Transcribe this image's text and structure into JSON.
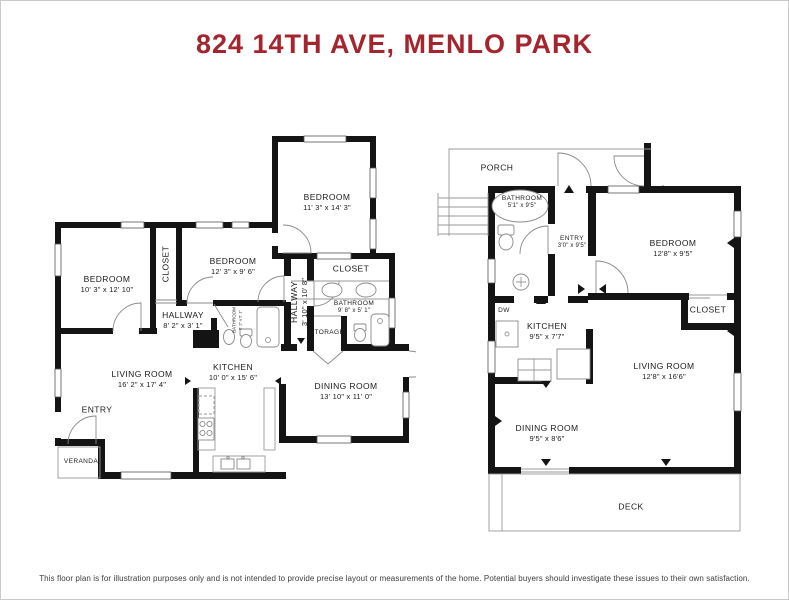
{
  "title": "824 14TH AVE, MENLO PARK",
  "colors": {
    "title": "#A4252E",
    "wall": "#141414"
  },
  "disclaimer": "This floor plan is for illustration purposes only and is not intended to provide precise layout or measurements of the home. Potential buyers should investigate these issues to their own satisfaction.",
  "plans": {
    "left": {
      "rooms": [
        {
          "name": "BEDROOM",
          "dims": "10' 3\" x 12' 10\""
        },
        {
          "name": "CLOSET"
        },
        {
          "name": "BEDROOM",
          "dims": "12' 3\" x 9' 6\""
        },
        {
          "name": "BEDROOM",
          "dims": "11' 3\" x 14' 3\""
        },
        {
          "name": "HALLWAY",
          "dims": "8' 2\" x 3' 1\""
        },
        {
          "name": "BATHROOM",
          "dims": "5' 2\" x 5' 1\""
        },
        {
          "name": "HALLWAY",
          "dims": "3' 10\" x 10' 8\""
        },
        {
          "name": "CLOSET"
        },
        {
          "name": "BATHROOM",
          "dims": "9' 8\" x 5' 1\""
        },
        {
          "name": "STORAGE"
        },
        {
          "name": "LIVING ROOM",
          "dims": "16' 2\" x 17' 4\""
        },
        {
          "name": "KITCHEN",
          "dims": "10' 0\" x 15' 6\""
        },
        {
          "name": "DINING ROOM",
          "dims": "13' 10\" x 11' 0\""
        },
        {
          "name": "ENTRY"
        },
        {
          "name": "VERANDA"
        }
      ]
    },
    "right": {
      "rooms": [
        {
          "name": "PORCH"
        },
        {
          "name": "BATHROOM",
          "dims": "5'1\" x 9'5\""
        },
        {
          "name": "ENTRY",
          "dims": "3'0\" x 9'5\""
        },
        {
          "name": "BEDROOM",
          "dims": "12'8\" x 9'5\""
        },
        {
          "name": "CLOSET"
        },
        {
          "name": "DW"
        },
        {
          "name": "KITCHEN",
          "dims": "9'5\" x 7'7\""
        },
        {
          "name": "LIVING ROOM",
          "dims": "12'8\" x 16'6\""
        },
        {
          "name": "DINING ROOM",
          "dims": "9'5\" x 8'6\""
        },
        {
          "name": "DECK"
        }
      ]
    }
  }
}
